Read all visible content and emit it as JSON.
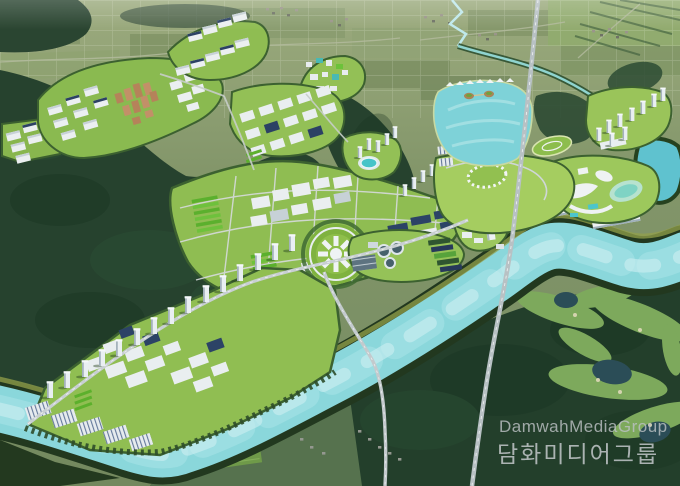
{
  "title": "Aerial master-plan rendering of a riverside new town",
  "watermark": {
    "en": "DamwahMediaGroup",
    "ko": "담화미디어그룹"
  },
  "palette": {
    "farmland": "#7e9266",
    "forest_dark": "#26422e",
    "platform_green": "#93c056",
    "strip_green": "#5bb02d",
    "building_white": "#ebeff1",
    "solar_navy": "#2c4164",
    "residential_orange": "#b5835a",
    "road_gray": "#c3cacd",
    "river_turquoise": "#8ad7db",
    "lake_turquoise": "#7ed2d8",
    "golf_pond_dark": "#2b4d57",
    "watermark_gray": "#c6cbce"
  },
  "scene": {
    "description": "Bird's-eye 3D rendering: planned industrial and residential districts along a turquoise river, reservoir lake with islands, lakeside park, resort water park, apartment tower rows, water-treatment plant, circular plaza complex, golf course in dark forest, farmland with villages to the north.",
    "regions": [
      {
        "id": "farmland-north",
        "label": "Farmland with scattered villages"
      },
      {
        "id": "mountain-forest-west",
        "label": "Dark forested mountains"
      },
      {
        "id": "industrial-park-northwest",
        "label": "Industrial park with orange residential blocks"
      },
      {
        "id": "north-industrial-sheds",
        "label": "Industrial sheds with navy solar roofs"
      },
      {
        "id": "midrise-grid-district",
        "label": "White mid-rise grid district"
      },
      {
        "id": "central-industrial-band",
        "label": "Central industrial band with green strips"
      },
      {
        "id": "circular-plaza",
        "label": "Circular radial plaza complex"
      },
      {
        "id": "water-treatment-plant",
        "label": "Water treatment plant with clarifier tanks"
      },
      {
        "id": "landmark-convention-center",
        "label": "White radial landmark building"
      },
      {
        "id": "office-slab-buildings",
        "label": "Long white slab buildings"
      },
      {
        "id": "resort-waterpark",
        "label": "Resort and water park with lagoon"
      },
      {
        "id": "reservoir-lake",
        "label": "Turquoise reservoir lake with two islands"
      },
      {
        "id": "lakeside-park",
        "label": "Lakeside park with canopy ring and oval lawns"
      },
      {
        "id": "east-pond",
        "label": "Pond at east edge fed by stream"
      },
      {
        "id": "riverside-apartment-row",
        "label": "Diagonal row of apartment towers"
      },
      {
        "id": "highrise-cluster-east",
        "label": "Apartment tower cluster east"
      },
      {
        "id": "logistics-district-southwest",
        "label": "Logistics district with solar parking arrays"
      },
      {
        "id": "river",
        "label": "Turquoise river with levees"
      },
      {
        "id": "highway",
        "label": "Highway crossing river on bridge"
      },
      {
        "id": "golf-course-southeast",
        "label": "Golf course with ponds in forest"
      },
      {
        "id": "rural-south-bank",
        "label": "Rural land south of river with hamlets"
      },
      {
        "id": "watermark",
        "label": "Watermark text"
      }
    ]
  }
}
